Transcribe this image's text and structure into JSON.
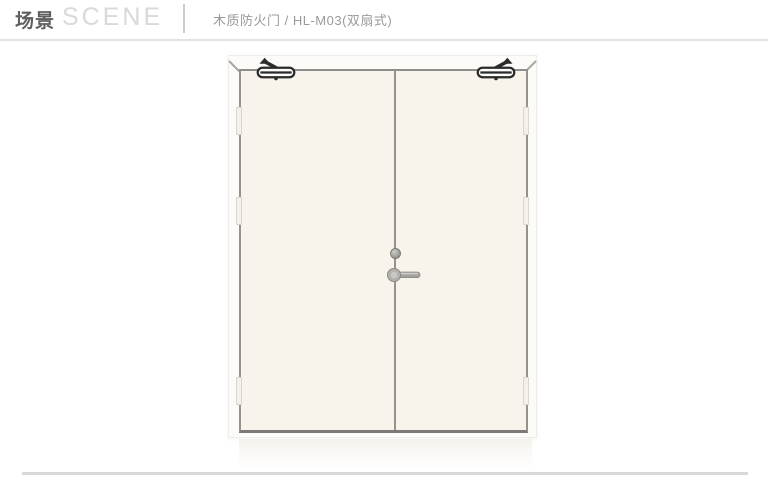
{
  "header": {
    "title_zh": "场景",
    "title_en": "SCENE",
    "subtitle": "木质防火门 / HL-M03(双扇式)"
  },
  "illustration": {
    "subject": "double-leaf-wooden-fire-door",
    "colors": {
      "door_face": "#f8f4ec",
      "frame_line": "#94928e",
      "hardware_dark": "#2b2b2b",
      "handle_metal": "#a3a19d",
      "header_accent": "#606060",
      "divider": "#e4e4e3"
    }
  }
}
